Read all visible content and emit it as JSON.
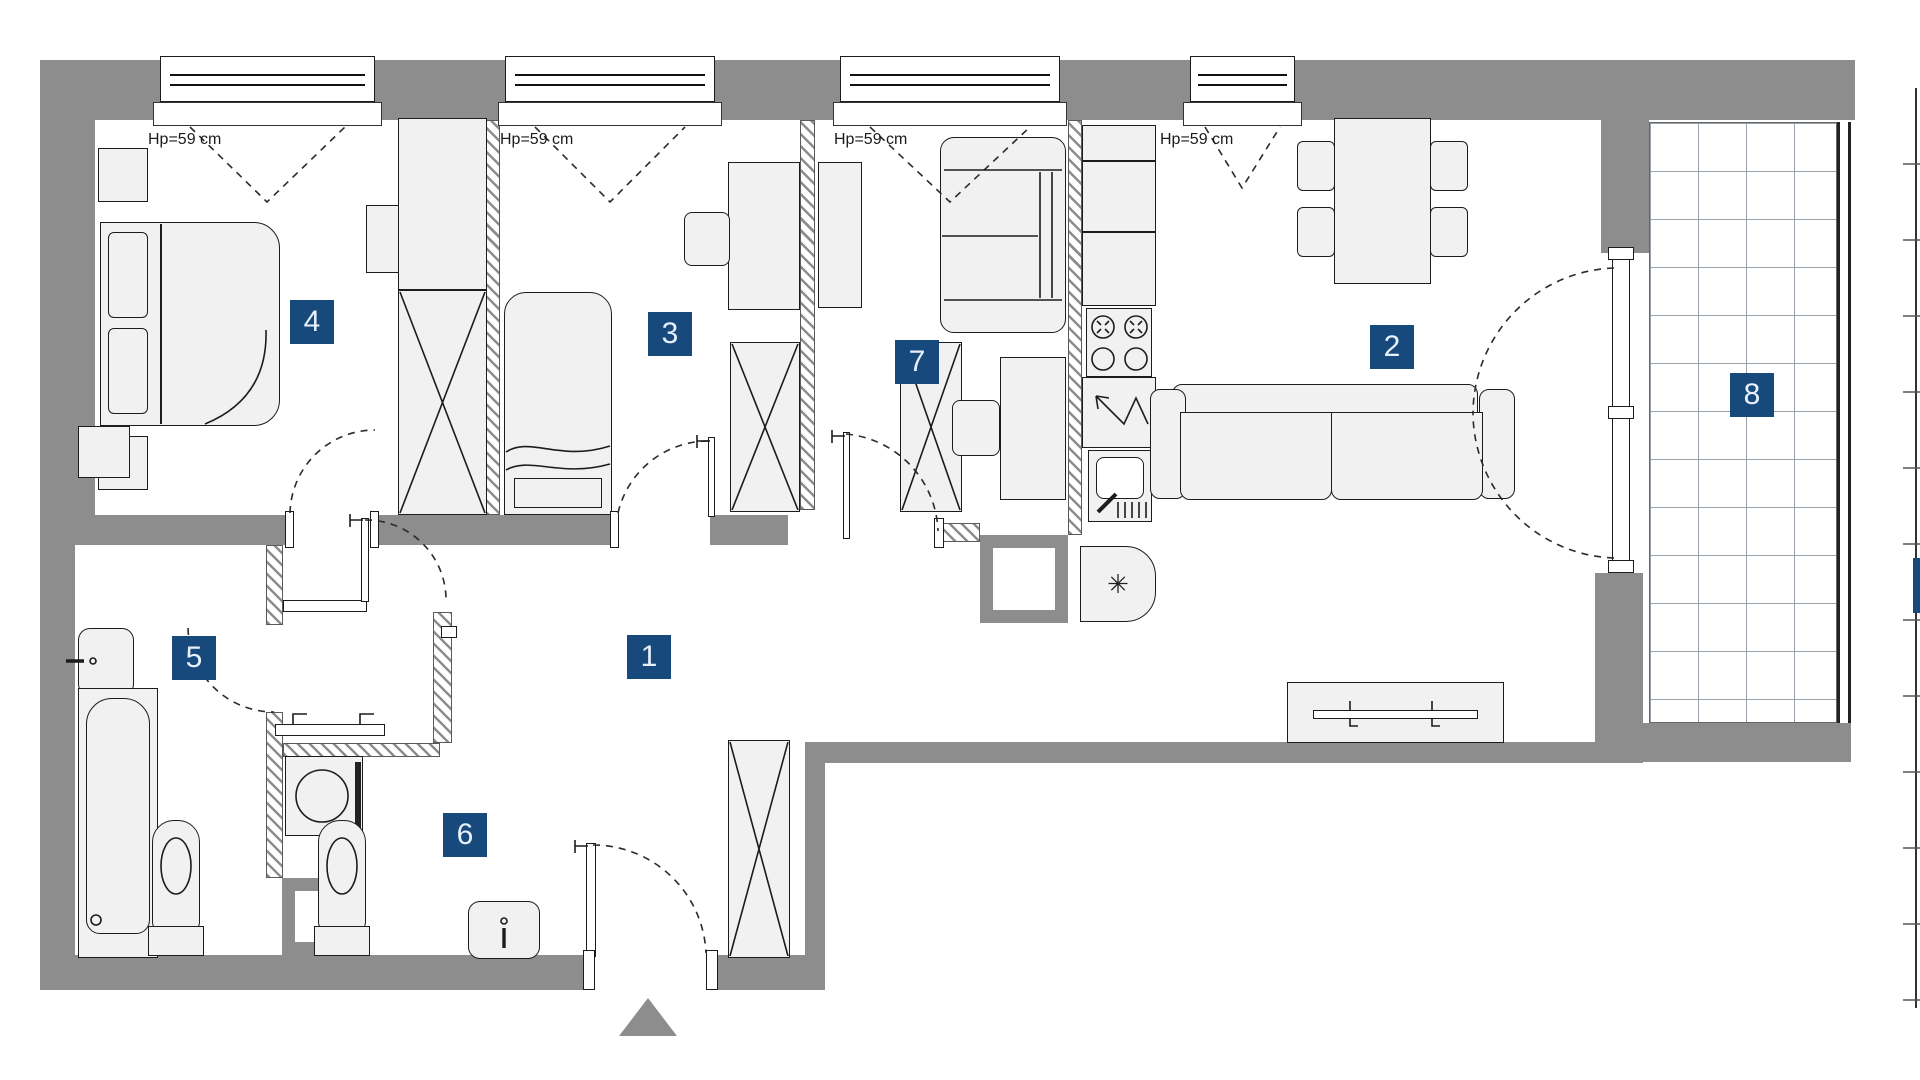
{
  "title": "apartment-floor-plan",
  "colors": {
    "wall": "#8d8d8d",
    "outline": "#1c1c1c",
    "furniture_fill": "#f1f1f1",
    "label_bg": "#17497d",
    "label_text": "#e8f1fb"
  },
  "rooms": [
    {
      "number": "1"
    },
    {
      "number": "2"
    },
    {
      "number": "3"
    },
    {
      "number": "4"
    },
    {
      "number": "5"
    },
    {
      "number": "6"
    },
    {
      "number": "7"
    },
    {
      "number": "8"
    }
  ],
  "windows": [
    {
      "label": "Hp=59 cm"
    },
    {
      "label": "Hp=59 cm"
    },
    {
      "label": "Hp=59 cm"
    },
    {
      "label": "Hp=59 cm"
    }
  ],
  "icons": {
    "snowflake_glyph": "✳",
    "entrance_marker": "triangle-up"
  }
}
